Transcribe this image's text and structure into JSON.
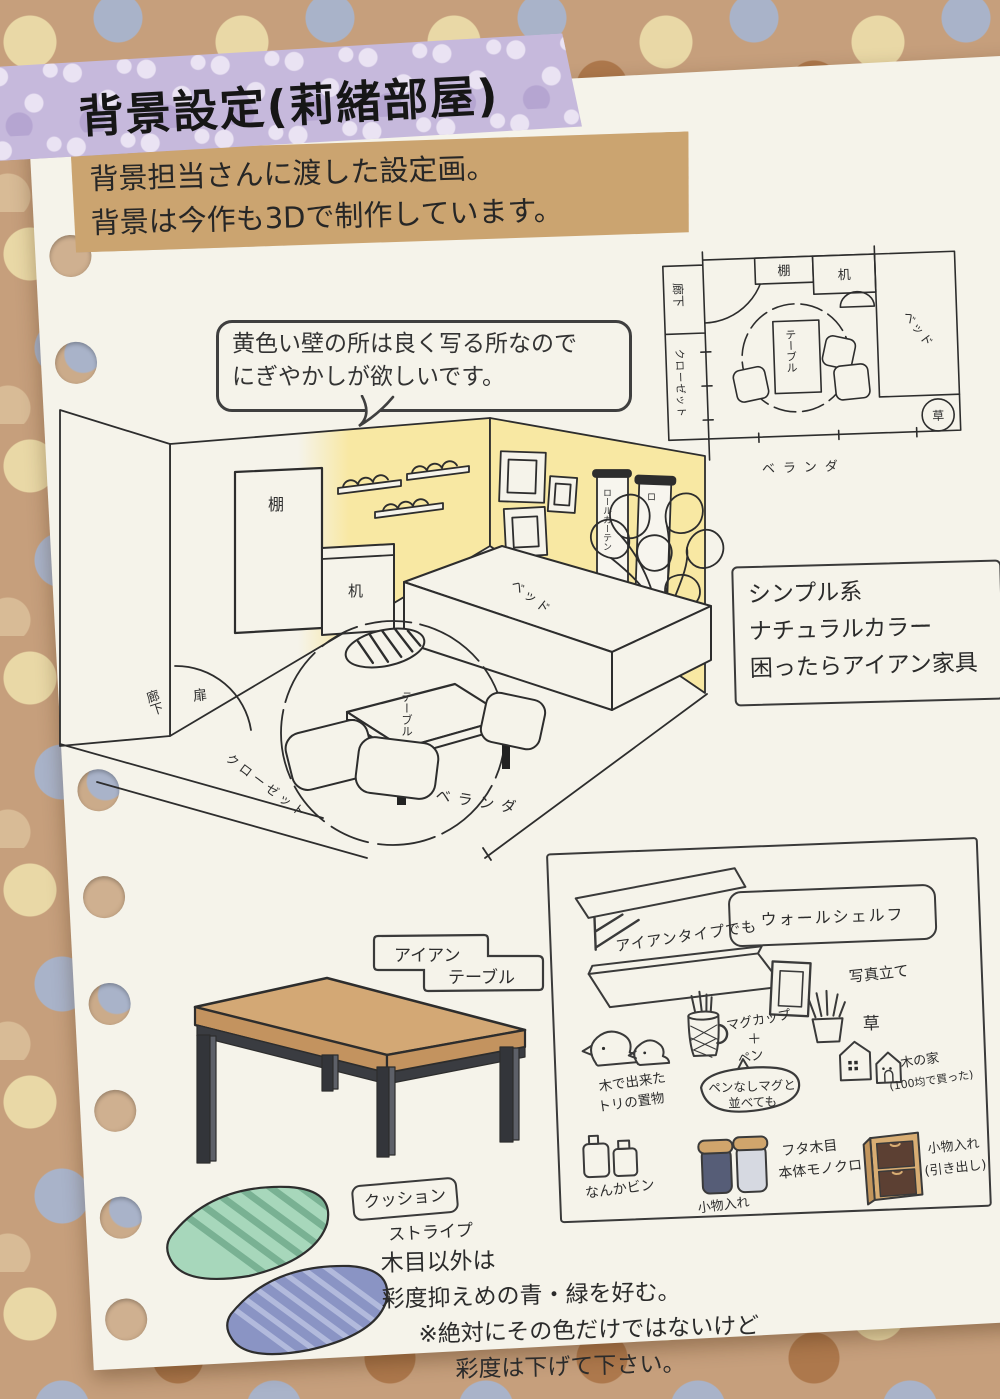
{
  "title_tape": {
    "text": "背景設定(莉緒部屋)"
  },
  "intro_note": {
    "line1": "背景担当さんに渡した設定画。",
    "line2": "背景は今作も3Dで制作しています。"
  },
  "speech_bubble": {
    "line1": "黄色い壁の所は良く写る所なので",
    "line2": "にぎやかしが欲しいです。"
  },
  "floor_plan": {
    "shelf": "棚",
    "desk": "机",
    "table": "テーブル",
    "bed": "ベッド",
    "hallway": "廊下",
    "closet": "クローゼット",
    "plant": "草",
    "veranda": "ベランダ"
  },
  "room": {
    "shelf": "棚",
    "desk": "机",
    "bed": "ベッド",
    "table": "テーブル",
    "door": "扉",
    "hallway": "廊下",
    "closet": "クローゼット",
    "veranda": "ベランダ",
    "roll_curtain": "ロールカーテン",
    "roll_curtain_short": "ロ"
  },
  "style_note": {
    "line1": "シンプル系",
    "line2": "ナチュラルカラー",
    "line3": "困ったらアイアン家具"
  },
  "iron_table": {
    "label_top": "アイアン",
    "label_bottom": "テーブル"
  },
  "cushion_note": {
    "label": "クッション",
    "style": "ストライプ"
  },
  "color_note": {
    "line1": "木目以外は",
    "line2": "彩度抑えめの青・緑を好む。",
    "line3": "※絶対にその色だけではないけど",
    "line4": "彩度は下げて下さい。"
  },
  "items": {
    "iron_type": "アイアンタイプでも",
    "wall_shelf": "ウォールシェルフ",
    "photo_stand": "写真立て",
    "bird_line1": "木で出来た",
    "bird_line2": "トリの置物",
    "mug_line1": "マグカップ",
    "mug_line2": "＋",
    "mug_line3": "ペン",
    "mug_bubble1": "ペンなしマグと",
    "mug_bubble2": "並べても",
    "grass": "草",
    "house_line1": "木の家",
    "house_line2": "(100均で買った)",
    "bottle": "なんかビン",
    "jar_note1": "フタ木目",
    "jar_note2": "本体モノクロ",
    "jar_label": "小物入れ",
    "drawer_line1": "小物入れ",
    "drawer_line2": "(引き出し)"
  },
  "colors": {
    "background_base": "#c69f7c",
    "dot_cream": "#e9d8a6",
    "dot_blue": "#a9b3c9",
    "dot_brown": "#ad784c",
    "paper": "#f5f3ea",
    "ink": "#2d2d2d",
    "title_tape": "#c6b9dc",
    "intro_tape": "#cba470",
    "wall_yellow": "#f8e8a3",
    "table_wood": "#d3a875",
    "table_iron": "#3a3c41",
    "cushion_green": "#a7d7bb",
    "cushion_green_stripe": "#79b193",
    "cushion_blue": "#8a94c4",
    "cushion_blue_stripe": "#b2badc",
    "jar_dark": "#565d77",
    "jar_light": "#d6d9e1",
    "jar_lid": "#d0a56c",
    "drawer_body": "#d8ad73",
    "drawer_face": "#5c4033"
  }
}
